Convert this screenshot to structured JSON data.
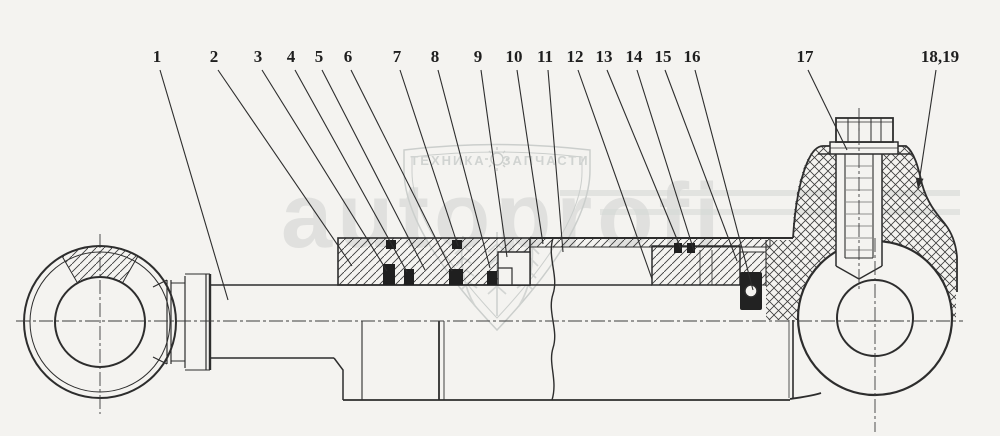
{
  "drawing": {
    "kind": "hydraulic-cylinder-cross-section",
    "colors": {
      "paper": "#f4f3f0",
      "ink": "#2d2d2d",
      "seal_black": "#1f1f1f",
      "watermark_gray": "#b1b7b5"
    },
    "watermark": {
      "wordmark": "autoprofi",
      "shield_band_left": "ТЕХНИКА",
      "shield_band_right": "ЗАПЧАСТИ",
      "gear_icon": "gear-icon",
      "wheat_icon": "wheat-ears-icon"
    },
    "callouts": [
      {
        "label": "1",
        "lx": 157,
        "ly": 62,
        "sx": 160,
        "sy": 70,
        "ex": 228,
        "ey": 300,
        "arrow": false
      },
      {
        "label": "2",
        "lx": 214,
        "ly": 62,
        "sx": 218,
        "sy": 70,
        "ex": 352,
        "ey": 266,
        "arrow": false
      },
      {
        "label": "3",
        "lx": 258,
        "ly": 62,
        "sx": 262,
        "sy": 70,
        "ex": 387,
        "ey": 271,
        "arrow": false
      },
      {
        "label": "4",
        "lx": 291,
        "ly": 62,
        "sx": 295,
        "sy": 70,
        "ex": 407,
        "ey": 272,
        "arrow": false
      },
      {
        "label": "5",
        "lx": 319,
        "ly": 62,
        "sx": 322,
        "sy": 70,
        "ex": 425,
        "ey": 270,
        "arrow": false
      },
      {
        "label": "6",
        "lx": 348,
        "ly": 62,
        "sx": 351,
        "sy": 70,
        "ex": 452,
        "ey": 271,
        "arrow": false
      },
      {
        "label": "7",
        "lx": 397,
        "ly": 62,
        "sx": 400,
        "sy": 70,
        "ex": 458,
        "ey": 246,
        "arrow": false
      },
      {
        "label": "8",
        "lx": 435,
        "ly": 62,
        "sx": 438,
        "sy": 70,
        "ex": 490,
        "ey": 268,
        "arrow": false
      },
      {
        "label": "9",
        "lx": 478,
        "ly": 62,
        "sx": 481,
        "sy": 70,
        "ex": 507,
        "ey": 257,
        "arrow": false
      },
      {
        "label": "10",
        "lx": 514,
        "ly": 62,
        "sx": 517,
        "sy": 70,
        "ex": 543,
        "ey": 244,
        "arrow": false
      },
      {
        "label": "11",
        "lx": 545,
        "ly": 62,
        "sx": 548,
        "sy": 70,
        "ex": 563,
        "ey": 252,
        "arrow": false
      },
      {
        "label": "12",
        "lx": 575,
        "ly": 62,
        "sx": 578,
        "sy": 70,
        "ex": 652,
        "ey": 279,
        "arrow": false
      },
      {
        "label": "13",
        "lx": 604,
        "ly": 62,
        "sx": 607,
        "sy": 70,
        "ex": 681,
        "ey": 249,
        "arrow": false
      },
      {
        "label": "14",
        "lx": 634,
        "ly": 62,
        "sx": 637,
        "sy": 70,
        "ex": 694,
        "ey": 251,
        "arrow": false
      },
      {
        "label": "15",
        "lx": 663,
        "ly": 62,
        "sx": 665,
        "sy": 70,
        "ex": 737,
        "ey": 261,
        "arrow": false
      },
      {
        "label": "16",
        "lx": 692,
        "ly": 62,
        "sx": 695,
        "sy": 70,
        "ex": 753,
        "ey": 290,
        "arrow": false
      },
      {
        "label": "17",
        "lx": 805,
        "ly": 62,
        "sx": 808,
        "sy": 70,
        "ex": 847,
        "ey": 150,
        "arrow": false
      },
      {
        "label": "18,19",
        "lx": 940,
        "ly": 62,
        "sx": 936,
        "sy": 70,
        "ex": 918,
        "ey": 189,
        "arrow": true
      }
    ]
  }
}
